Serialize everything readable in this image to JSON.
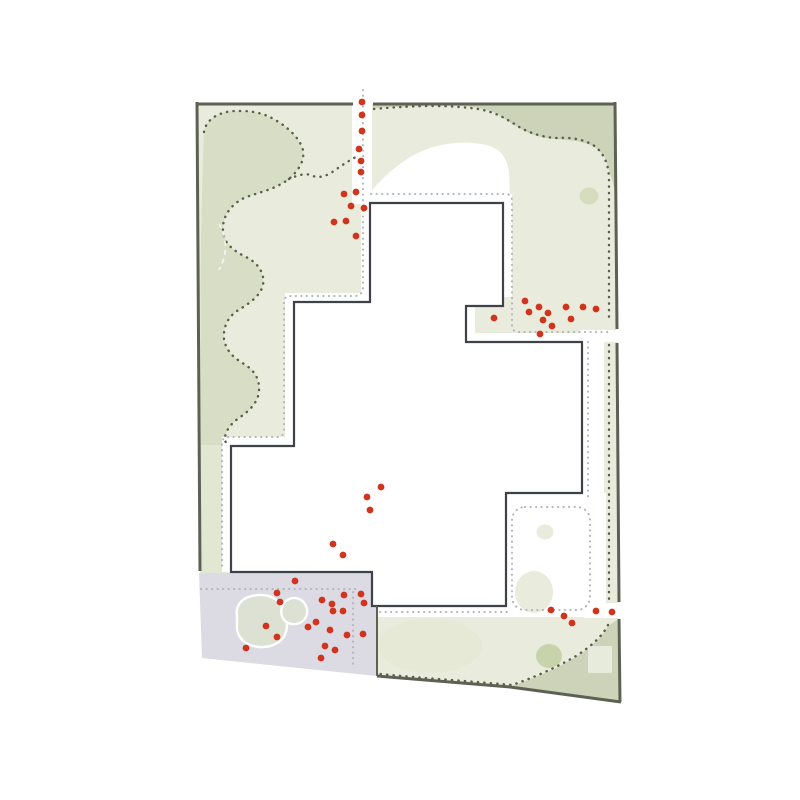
{
  "map": {
    "kind": "landscape-site-plan",
    "canvas": {
      "width": 800,
      "height": 800
    },
    "regions": {
      "site": "site-parcel",
      "building": "building-footprint",
      "lawn_left": "mown-lawn-left",
      "lawn_top_right": "lawn-band-top-right",
      "paved": "paved-area-bottom-left",
      "pond": "pond",
      "courtyard": "courtyard-garden",
      "paths_dark": "perimeter-gravel-path",
      "paths_gray": "building-walkway-path"
    }
  },
  "palette": {
    "light": "#e9ecdc",
    "sage": "#ccd3b9",
    "blob": "#d8dec6",
    "strip": "#e2e7d1",
    "lavender": "#dcdbe4",
    "pond": "#dce1d4",
    "soft": "#e3e8d2",
    "darkgreen": "#c9d3ab",
    "palepatch": "#e6ebdb",
    "boundary": "#5d6153",
    "building": "#3f4246",
    "dotdark": "#5a5f49",
    "dotgray": "#b3b3bc",
    "red": "#d0341d"
  },
  "chart_data": {
    "type": "scatter",
    "title": "",
    "series_name": "red-point-markers",
    "count": 56,
    "points": [
      [
        362,
        102
      ],
      [
        362,
        115
      ],
      [
        362,
        131
      ],
      [
        359,
        149
      ],
      [
        361,
        161
      ],
      [
        361,
        172
      ],
      [
        356,
        192
      ],
      [
        344,
        194
      ],
      [
        351,
        206
      ],
      [
        364,
        208
      ],
      [
        334,
        222
      ],
      [
        346,
        221
      ],
      [
        356,
        236
      ],
      [
        525,
        301
      ],
      [
        494,
        318
      ],
      [
        529,
        312
      ],
      [
        539,
        307
      ],
      [
        548,
        313
      ],
      [
        543,
        320
      ],
      [
        552,
        326
      ],
      [
        540,
        334
      ],
      [
        566,
        307
      ],
      [
        571,
        319
      ],
      [
        583,
        307
      ],
      [
        596,
        309
      ],
      [
        381,
        487
      ],
      [
        367,
        497
      ],
      [
        370,
        510
      ],
      [
        333,
        544
      ],
      [
        343,
        555
      ],
      [
        295,
        581
      ],
      [
        277,
        593
      ],
      [
        280,
        602
      ],
      [
        322,
        600
      ],
      [
        332,
        604
      ],
      [
        344,
        595
      ],
      [
        361,
        594
      ],
      [
        364,
        603
      ],
      [
        343,
        611
      ],
      [
        333,
        611
      ],
      [
        266,
        626
      ],
      [
        277,
        637
      ],
      [
        246,
        648
      ],
      [
        308,
        627
      ],
      [
        316,
        622
      ],
      [
        330,
        630
      ],
      [
        347,
        635
      ],
      [
        363,
        634
      ],
      [
        325,
        646
      ],
      [
        335,
        650
      ],
      [
        321,
        658
      ],
      [
        551,
        610
      ],
      [
        564,
        616
      ],
      [
        572,
        623
      ],
      [
        596,
        611
      ],
      [
        612,
        612
      ]
    ],
    "marker_radius": 3.4
  }
}
